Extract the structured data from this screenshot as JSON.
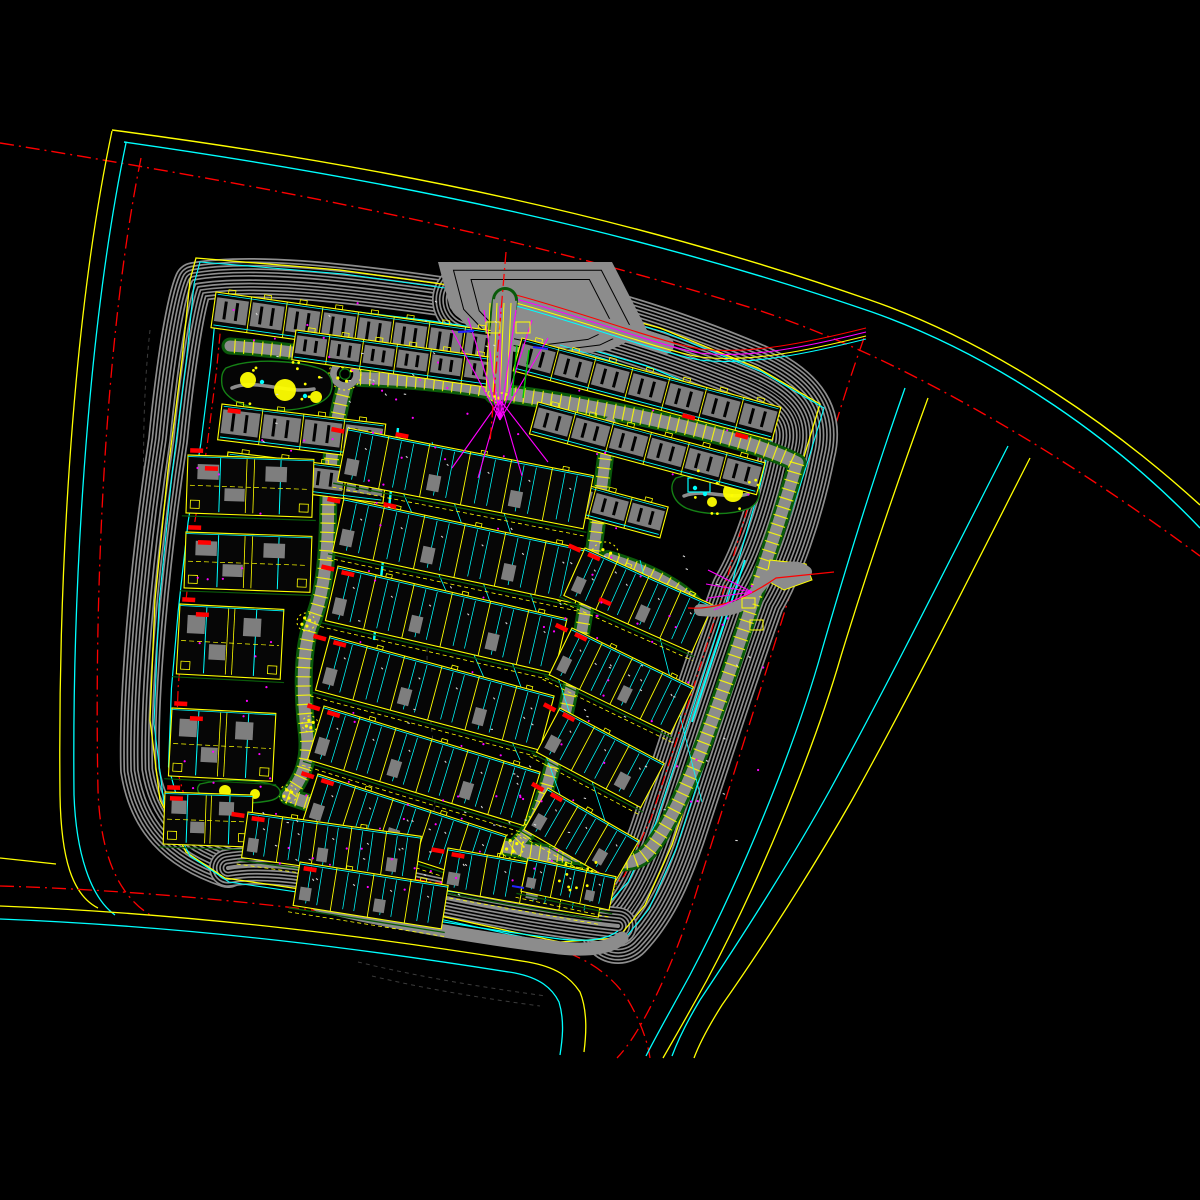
{
  "meta": {
    "app": "cad-site-plan",
    "description": "Black model-space CAD master plan of a residential compound"
  },
  "canvas": {
    "w": 1200,
    "h": 1200,
    "bg": "#000000"
  },
  "palette": {
    "yellow": "#ffff00",
    "cyan": "#00ffff",
    "red": "#ff0000",
    "magenta": "#ff00ff",
    "blue": "#2424ff",
    "white": "#d9d9d9",
    "hatch": "#8d8d8d",
    "road": "#8c8c8c",
    "roof": "#7e7e7e",
    "green": "#0a5a0a",
    "green2": "#158015",
    "brightgreen": "#00cc00",
    "dim": "#3c3c3c"
  },
  "outer_roads": [
    {
      "c": "yellow",
      "w": 1.4,
      "dash": null,
      "d": "M112,130 C400,168 640,220 870,300 C1000,345 1120,432 1200,505"
    },
    {
      "c": "cyan",
      "w": 1.4,
      "dash": null,
      "d": "M124,142 C405,182 645,234 872,312 C1002,358 1120,444 1200,528"
    },
    {
      "c": "red",
      "w": 1.4,
      "dash": "14 5 2 5",
      "d": "M0,143 C280,188 520,235 758,310 C900,357 1060,452 1200,556"
    },
    {
      "c": "yellow",
      "w": 1.3,
      "dash": null,
      "d": "M112,131 C70,330 58,600 60,795 C61,858 72,895 98,908"
    },
    {
      "c": "cyan",
      "w": 1.3,
      "dash": null,
      "d": "M126,143 C86,335 72,600 74,795 C76,852 90,897 115,915"
    },
    {
      "c": "red",
      "w": 1.3,
      "dash": "14 5 2 5",
      "d": "M141,158 C104,340 94,600 98,790 C100,850 116,895 152,916"
    },
    {
      "c": "yellow",
      "w": 1.2,
      "dash": null,
      "d": "M0,858 L56,864"
    },
    {
      "c": "red",
      "w": 1.3,
      "dash": "14 5 2 5",
      "d": "M0,886 C200,892 400,918 540,945 C580,953 610,972 628,1000 C642,1024 648,1044 650,1058"
    },
    {
      "c": "yellow",
      "w": 1.3,
      "dash": null,
      "d": "M0,906 C200,914 380,938 528,962 C556,967 570,977 580,992 C588,1012 586,1036 584,1052"
    },
    {
      "c": "cyan",
      "w": 1.3,
      "dash": null,
      "d": "M0,919 C200,927 370,950 515,973 C540,978 552,988 559,1002 C565,1022 562,1042 560,1055"
    },
    {
      "c": "red",
      "w": 1.3,
      "dash": "14 5 2 5",
      "d": "M864,338 C842,400 818,478 798,568 C770,660 735,770 700,880 C686,928 664,985 640,1026 C630,1043 622,1053 617,1058"
    },
    {
      "c": "cyan",
      "w": 1.3,
      "dash": null,
      "d": "M905,388 C876,470 848,560 822,650 C794,750 740,880 690,975 C672,1008 656,1036 646,1056"
    },
    {
      "c": "yellow",
      "w": 1.3,
      "dash": null,
      "d": "M928,398 C898,480 868,568 841,656 C812,756 757,886 707,980 C690,1011 674,1039 663,1058"
    },
    {
      "c": "cyan",
      "w": 1.3,
      "dash": null,
      "d": "M1008,446 C950,560 890,680 830,790 C790,862 740,940 700,1000 C688,1020 678,1040 672,1056"
    },
    {
      "c": "yellow",
      "w": 1.3,
      "dash": null,
      "d": "M1030,458 C972,572 912,692 852,800 C812,870 762,948 722,1005 C710,1024 700,1042 694,1058"
    }
  ],
  "terrain": [
    "M150,330 C140,420 143,520 150,620 C155,700 149,780 156,838",
    "M430,600 C424,650 428,700 434,750 C438,790 434,820 428,845",
    "M358,962 C420,977 480,987 546,996",
    "M372,976 C430,990 488,999 540,1006"
  ],
  "boundary": {
    "step": 3.4,
    "band": [
      {
        "w": 40,
        "d": "M228,868 C175,850 148,820 140,770 C138,690 150,560 168,440 C176,360 186,300 194,282 C250,272 340,282 440,296 L470,300"
      },
      {
        "w": 76,
        "d": "M470,300 C570,314 660,342 750,380 C790,398 806,418 798,450 C786,510 766,565 748,595 C726,655 700,735 668,832 C653,876 638,905 618,926"
      },
      {
        "w": 38,
        "d": "M618,926 C560,920 480,906 400,888 C340,875 275,860 228,868"
      }
    ],
    "outline": [
      [
        196,
        258
      ],
      [
        340,
        270
      ],
      [
        470,
        288
      ],
      [
        565,
        302
      ],
      [
        660,
        328
      ],
      [
        758,
        368
      ],
      [
        820,
        404
      ],
      [
        800,
        470
      ],
      [
        772,
        552
      ],
      [
        756,
        592
      ],
      [
        736,
        652
      ],
      [
        706,
        742
      ],
      [
        672,
        845
      ],
      [
        645,
        905
      ],
      [
        618,
        938
      ],
      [
        560,
        942
      ],
      [
        440,
        916
      ],
      [
        320,
        892
      ],
      [
        225,
        878
      ],
      [
        186,
        852
      ],
      [
        160,
        800
      ],
      [
        150,
        720
      ],
      [
        155,
        600
      ],
      [
        168,
        470
      ],
      [
        182,
        360
      ],
      [
        190,
        280
      ]
    ],
    "site": [
      [
        212,
        288
      ],
      [
        330,
        302
      ],
      [
        428,
        314
      ],
      [
        468,
        320
      ],
      [
        560,
        334
      ],
      [
        650,
        360
      ],
      [
        742,
        398
      ],
      [
        780,
        428
      ],
      [
        766,
        486
      ],
      [
        748,
        548
      ],
      [
        737,
        586
      ],
      [
        720,
        642
      ],
      [
        692,
        730
      ],
      [
        660,
        828
      ],
      [
        632,
        888
      ],
      [
        608,
        914
      ],
      [
        585,
        918
      ],
      [
        505,
        906
      ],
      [
        420,
        893
      ],
      [
        330,
        874
      ],
      [
        240,
        850
      ],
      [
        218,
        845
      ],
      [
        175,
        818
      ],
      [
        162,
        770
      ],
      [
        165,
        690
      ],
      [
        172,
        610
      ],
      [
        182,
        520
      ],
      [
        195,
        440
      ],
      [
        205,
        360
      ]
    ],
    "cyan_f": 0.978,
    "red_f": 0.955
  },
  "strip": {
    "road": "M318,905 C400,925 480,938 560,948 C590,951 610,948 622,938",
    "w": 13,
    "edge": "M315,896 C400,916 480,929 560,939 C588,942 606,940 618,931"
  },
  "gate_top": {
    "apron": [
      [
        438,
        262
      ],
      [
        612,
        262
      ],
      [
        648,
        332
      ],
      [
        610,
        350
      ],
      [
        545,
        358
      ],
      [
        486,
        346
      ],
      [
        450,
        308
      ]
    ],
    "slip": "M516,302 C570,315 620,332 665,345",
    "slip_w": 18,
    "slip_line": "M516,298 C590,318 660,345 700,352 C750,358 810,345 866,331",
    "slip_offsets": [
      [
        "red",
        -3
      ],
      [
        "magenta",
        1
      ],
      [
        "yellow",
        5
      ],
      [
        "cyan",
        8
      ]
    ],
    "road": "M505,300 L498,392",
    "road_w": 24,
    "yellow_xs": [
      490,
      497,
      504,
      511
    ],
    "fan1": {
      "from": [
        500,
        420
      ],
      "to": [
        [
          452,
          330
        ],
        [
          468,
          318
        ],
        [
          484,
          310
        ],
        [
          500,
          306
        ],
        [
          516,
          310
        ],
        [
          532,
          320
        ],
        [
          548,
          338
        ]
      ]
    },
    "fan2": {
      "from": [
        500,
        400
      ],
      "to": [
        [
          452,
          468
        ],
        [
          478,
          478
        ],
        [
          522,
          476
        ],
        [
          548,
          462
        ]
      ]
    },
    "red": "M506,252 L490,442",
    "boxes": [
      [
        486,
        322,
        14,
        11
      ],
      [
        516,
        322,
        14,
        11
      ]
    ],
    "blue": [
      458,
      332,
      474,
      331
    ],
    "greens": [
      [
        517,
        345,
        512,
        396
      ],
      [
        529,
        350,
        523,
        398
      ]
    ]
  },
  "gate_right": {
    "sroad": "M700,610 C720,612 738,610 748,600 C760,588 764,578 776,572 C790,565 800,567 806,572",
    "w": 12,
    "flare": [
      [
        770,
        560
      ],
      [
        806,
        564
      ],
      [
        812,
        580
      ],
      [
        784,
        590
      ],
      [
        766,
        580
      ]
    ],
    "red": "M688,608 C720,610 750,596 776,578 L834,572",
    "boxes": [
      [
        742,
        598,
        13,
        10
      ],
      [
        750,
        620,
        13,
        10
      ]
    ],
    "fan": {
      "from": [
        752,
        592
      ],
      "to": [
        [
          708,
          570
        ],
        [
          706,
          584
        ],
        [
          708,
          598
        ],
        [
          714,
          610
        ]
      ]
    }
  },
  "roads": [
    {
      "d": "M505,300 L498,345 L496,392",
      "w": 20,
      "t": false
    },
    {
      "d": "M345,360 C300,352 262,348 230,346",
      "w": 11,
      "t": true
    },
    {
      "d": "M360,378 C420,380 470,386 496,392",
      "w": 12,
      "t": true
    },
    {
      "d": "M345,386 C333,430 328,480 328,520 C327,570 322,600 310,628 C301,660 303,700 307,734 C310,764 300,782 288,796",
      "w": 12,
      "t": true
    },
    {
      "d": "M288,796 C340,815 430,834 512,848 C532,851 546,853 560,855",
      "w": 12,
      "t": true
    },
    {
      "d": "M496,392 C600,406 690,426 755,446 C772,452 786,457 797,463",
      "w": 13,
      "t": true
    },
    {
      "d": "M797,463 C785,505 771,545 760,580 C745,625 728,680 705,740 C688,785 668,828 648,852 C636,865 618,864 603,859 C588,856 572,856 560,855",
      "w": 12,
      "t": true
    },
    {
      "d": "M610,422 C602,480 594,560 582,630 C572,685 558,752 542,802 C534,826 524,840 512,848",
      "w": 11,
      "t": true
    },
    {
      "d": "M608,558 C655,572 688,592 700,610",
      "w": 10,
      "t": true
    },
    {
      "d": "M512,848 C538,858 556,866 572,878",
      "w": 9,
      "t": false
    }
  ],
  "roundabout": {
    "x": 345,
    "y": 374,
    "r": 15
  },
  "junctions": [
    [
      345,
      374,
      16
    ],
    [
      605,
      556,
      14
    ],
    [
      512,
      846,
      12
    ],
    [
      306,
      622,
      9
    ],
    [
      310,
      724,
      8
    ],
    [
      288,
      794,
      9
    ],
    [
      576,
      879,
      9
    ],
    [
      498,
      394,
      9
    ],
    [
      700,
      611,
      8
    ]
  ],
  "courtyards": [
    {
      "d": "M226,368 C250,358 292,360 318,368 C331,372 335,382 330,394 C322,407 290,413 262,409 C240,406 224,397 222,385 C221,377 222,372 226,368 Z",
      "g": "M232,388 C255,378 285,394 314,389",
      "blobs": [
        [
          248,
          380,
          8
        ],
        [
          285,
          390,
          11
        ],
        [
          316,
          397,
          6
        ]
      ],
      "cy": [
        [
          262,
          382
        ],
        [
          305,
          396
        ]
      ],
      "pool": null
    },
    {
      "d": "M676,478 C700,470 728,472 752,482 C762,488 762,500 750,508 C730,516 702,515 686,508 C672,501 668,486 676,478 Z",
      "g": "M684,496 C704,488 728,500 748,494",
      "blobs": [
        [
          733,
          492,
          10
        ],
        [
          712,
          502,
          5
        ]
      ],
      "cy": [
        [
          695,
          488
        ],
        [
          705,
          494
        ]
      ],
      "pool": [
        688,
        478,
        22,
        14
      ]
    },
    {
      "d": "M200,784 C225,778 262,780 276,786 C284,792 280,799 268,801 C245,805 215,803 203,797 C197,792 196,788 200,784 Z",
      "g": null,
      "blobs": [
        [
          225,
          791,
          6
        ],
        [
          255,
          794,
          5
        ]
      ],
      "cy": [],
      "pool": null
    },
    {
      "d": "M556,868 C572,862 590,872 595,884 C597,892 589,897 578,894 C566,891 554,878 556,868 Z",
      "g": null,
      "blobs": [
        [
          578,
          882,
          5
        ]
      ],
      "cy": [],
      "pool": null
    }
  ],
  "cyan_lines": [
    [
      380,
      440,
      520,
      760,
      0.8
    ],
    [
      432,
      442,
      562,
      800,
      0.8
    ],
    [
      484,
      452,
      606,
      824,
      0.8
    ],
    [
      640,
      560,
      702,
      802,
      0.8
    ],
    [
      398,
      428,
      374,
      640,
      2.4
    ],
    [
      745,
      560,
      692,
      722,
      1.8
    ],
    [
      560,
      345,
      768,
      410,
      0.9
    ]
  ],
  "buildings": [
    {
      "x": 216,
      "y": 292,
      "w": 288,
      "h": 36,
      "a": 8,
      "u": 8,
      "s": "apt",
      "m": 0
    },
    {
      "x": 296,
      "y": 330,
      "w": 205,
      "h": 30,
      "a": 8,
      "u": 6,
      "s": "apt",
      "m": 0
    },
    {
      "x": 222,
      "y": 404,
      "w": 165,
      "h": 36,
      "a": 7,
      "u": 4,
      "s": "apt",
      "m": 0
    },
    {
      "x": 228,
      "y": 452,
      "w": 160,
      "h": 32,
      "a": 7,
      "u": 4,
      "s": "apt",
      "m": 0
    },
    {
      "x": 522,
      "y": 338,
      "w": 268,
      "h": 34,
      "a": 15,
      "u": 7,
      "s": "apt",
      "m": 0
    },
    {
      "x": 538,
      "y": 402,
      "w": 235,
      "h": 33,
      "a": 15,
      "u": 6,
      "s": "apt",
      "m": 0
    },
    {
      "x": 560,
      "y": 478,
      "w": 112,
      "h": 32,
      "a": 15,
      "u": 3,
      "s": "apt",
      "m": 0
    },
    {
      "x": 188,
      "y": 455,
      "w": 126,
      "h": 58,
      "a": 2,
      "u": 2,
      "s": "villa",
      "m": 1
    },
    {
      "x": 186,
      "y": 532,
      "w": 126,
      "h": 56,
      "a": 2,
      "u": 2,
      "s": "villa",
      "m": 1
    },
    {
      "x": 180,
      "y": 604,
      "w": 104,
      "h": 70,
      "a": 3,
      "u": 2,
      "s": "villa",
      "m": 1
    },
    {
      "x": 172,
      "y": 708,
      "w": 104,
      "h": 68,
      "a": 3,
      "u": 2,
      "s": "villa",
      "m": 1
    },
    {
      "x": 165,
      "y": 792,
      "w": 88,
      "h": 52,
      "a": 2,
      "u": 2,
      "s": "villa",
      "m": 1
    },
    {
      "x": 348,
      "y": 428,
      "w": 250,
      "h": 54,
      "a": 11,
      "u": 6,
      "s": "town",
      "m": 1
    },
    {
      "x": 344,
      "y": 498,
      "w": 248,
      "h": 55,
      "a": 12,
      "u": 6,
      "s": "town",
      "m": 1
    },
    {
      "x": 338,
      "y": 566,
      "w": 235,
      "h": 56,
      "a": 13,
      "u": 6,
      "s": "town",
      "m": 1
    },
    {
      "x": 330,
      "y": 636,
      "w": 232,
      "h": 56,
      "a": 15,
      "u": 6,
      "s": "town",
      "m": 1
    },
    {
      "x": 324,
      "y": 706,
      "w": 226,
      "h": 56,
      "a": 17,
      "u": 6,
      "s": "town",
      "m": 1
    },
    {
      "x": 318,
      "y": 774,
      "w": 198,
      "h": 52,
      "a": 18,
      "u": 5,
      "s": "town",
      "m": 1
    },
    {
      "x": 585,
      "y": 548,
      "w": 140,
      "h": 52,
      "a": 24,
      "u": 4,
      "s": "town",
      "m": 1
    },
    {
      "x": 572,
      "y": 628,
      "w": 135,
      "h": 52,
      "a": 26,
      "u": 4,
      "s": "town",
      "m": 1
    },
    {
      "x": 560,
      "y": 708,
      "w": 118,
      "h": 50,
      "a": 28,
      "u": 3,
      "s": "town",
      "m": 1
    },
    {
      "x": 548,
      "y": 788,
      "w": 105,
      "h": 48,
      "a": 30,
      "u": 3,
      "s": "town",
      "m": 1
    },
    {
      "x": 248,
      "y": 812,
      "w": 175,
      "h": 46,
      "a": 8,
      "u": 5,
      "s": "town",
      "m": 1
    },
    {
      "x": 448,
      "y": 848,
      "w": 160,
      "h": 42,
      "a": 10,
      "u": 4,
      "s": "town",
      "m": 1
    },
    {
      "x": 300,
      "y": 862,
      "w": 150,
      "h": 44,
      "a": 9,
      "u": 4,
      "s": "town",
      "m": 0
    },
    {
      "x": 528,
      "y": 858,
      "w": 90,
      "h": 34,
      "a": 12,
      "u": 3,
      "s": "town",
      "m": 0
    }
  ],
  "red_marks": [
    [
      396,
      432,
      11
    ],
    [
      384,
      502,
      12
    ],
    [
      342,
      570,
      13
    ],
    [
      334,
      640,
      15
    ],
    [
      328,
      710,
      17
    ],
    [
      322,
      778,
      18
    ],
    [
      589,
      552,
      24
    ],
    [
      576,
      632,
      26
    ],
    [
      564,
      712,
      28
    ],
    [
      552,
      792,
      30
    ],
    [
      205,
      466,
      2
    ],
    [
      198,
      540,
      2
    ],
    [
      196,
      612,
      3
    ],
    [
      190,
      716,
      3
    ],
    [
      252,
      816,
      8
    ],
    [
      452,
      852,
      10
    ],
    [
      304,
      866,
      9
    ],
    [
      228,
      408,
      7
    ],
    [
      683,
      413,
      15
    ],
    [
      736,
      432,
      15
    ],
    [
      600,
      597,
      24
    ],
    [
      170,
      796,
      2
    ]
  ],
  "blue_ticks": [
    [
      458,
      332,
      474,
      331
    ],
    [
      533,
      347,
      548,
      349
    ],
    [
      512,
      886,
      524,
      888
    ]
  ],
  "scatter": {
    "magenta": {
      "seed": 7,
      "n": 100,
      "r": [
        [
          230,
          300,
          300,
          160
        ],
        [
          330,
          430,
          280,
          380
        ],
        [
          560,
          470,
          210,
          360
        ],
        [
          250,
          795,
          330,
          100
        ],
        [
          175,
          460,
          130,
          330
        ]
      ]
    },
    "white": {
      "seed": 11,
      "n": 85,
      "r": [
        [
          240,
          300,
          260,
          150
        ],
        [
          340,
          435,
          300,
          400
        ],
        [
          570,
          555,
          180,
          290
        ],
        [
          255,
          805,
          320,
          90
        ]
      ]
    },
    "ydots": {
      "seed": 5,
      "n": 30,
      "r": [
        [
          226,
          362,
          110,
          48
        ],
        [
          676,
          470,
          88,
          44
        ],
        [
          556,
          862,
          40,
          32
        ]
      ]
    }
  }
}
